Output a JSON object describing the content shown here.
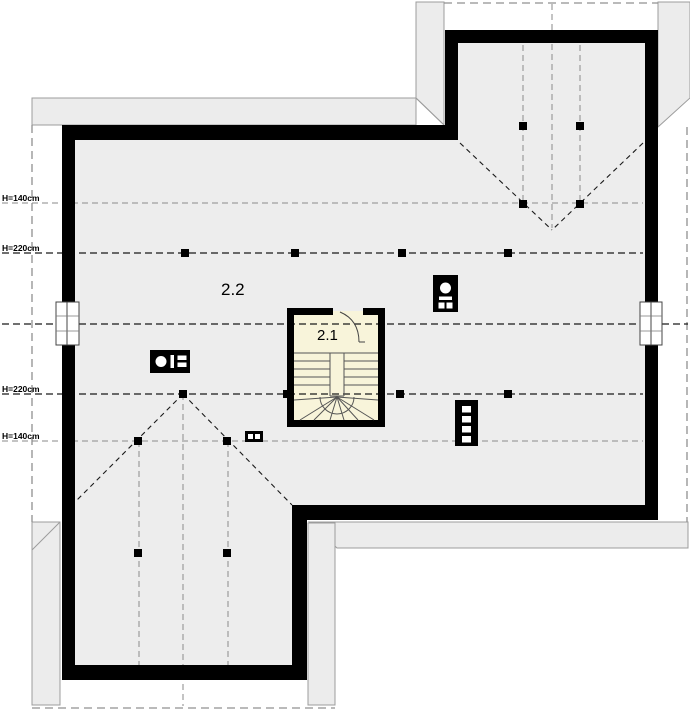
{
  "plan": {
    "rooms": [
      {
        "id": "room-2-2",
        "label": "2.2"
      },
      {
        "id": "room-2-1",
        "label": "2.1"
      }
    ],
    "height_lines": [
      {
        "label": "H=140cm",
        "y": 203
      },
      {
        "label": "H=220cm",
        "y": 253
      },
      {
        "label": "H=220cm",
        "y": 394
      },
      {
        "label": "H=140cm",
        "y": 441
      }
    ],
    "fixtures": [
      {
        "name": "chimney-flue-icon"
      },
      {
        "name": "boiler-flue-icon"
      },
      {
        "name": "vent-stack-icon"
      },
      {
        "name": "small-vent-icon"
      }
    ],
    "features": [
      {
        "name": "staircase-winder"
      },
      {
        "name": "door-room-2-1"
      },
      {
        "name": "window-left"
      },
      {
        "name": "window-right"
      }
    ],
    "colors": {
      "wall": "#000000",
      "floor": "#EDEDED",
      "eave": "#ECECEC",
      "eave_border": "#9C9C9C",
      "stair_room": "#F8F4DA",
      "contour_dark": "#1A1A1A",
      "contour_light": "#8A8A8A",
      "roof_outline": "#909090"
    }
  }
}
